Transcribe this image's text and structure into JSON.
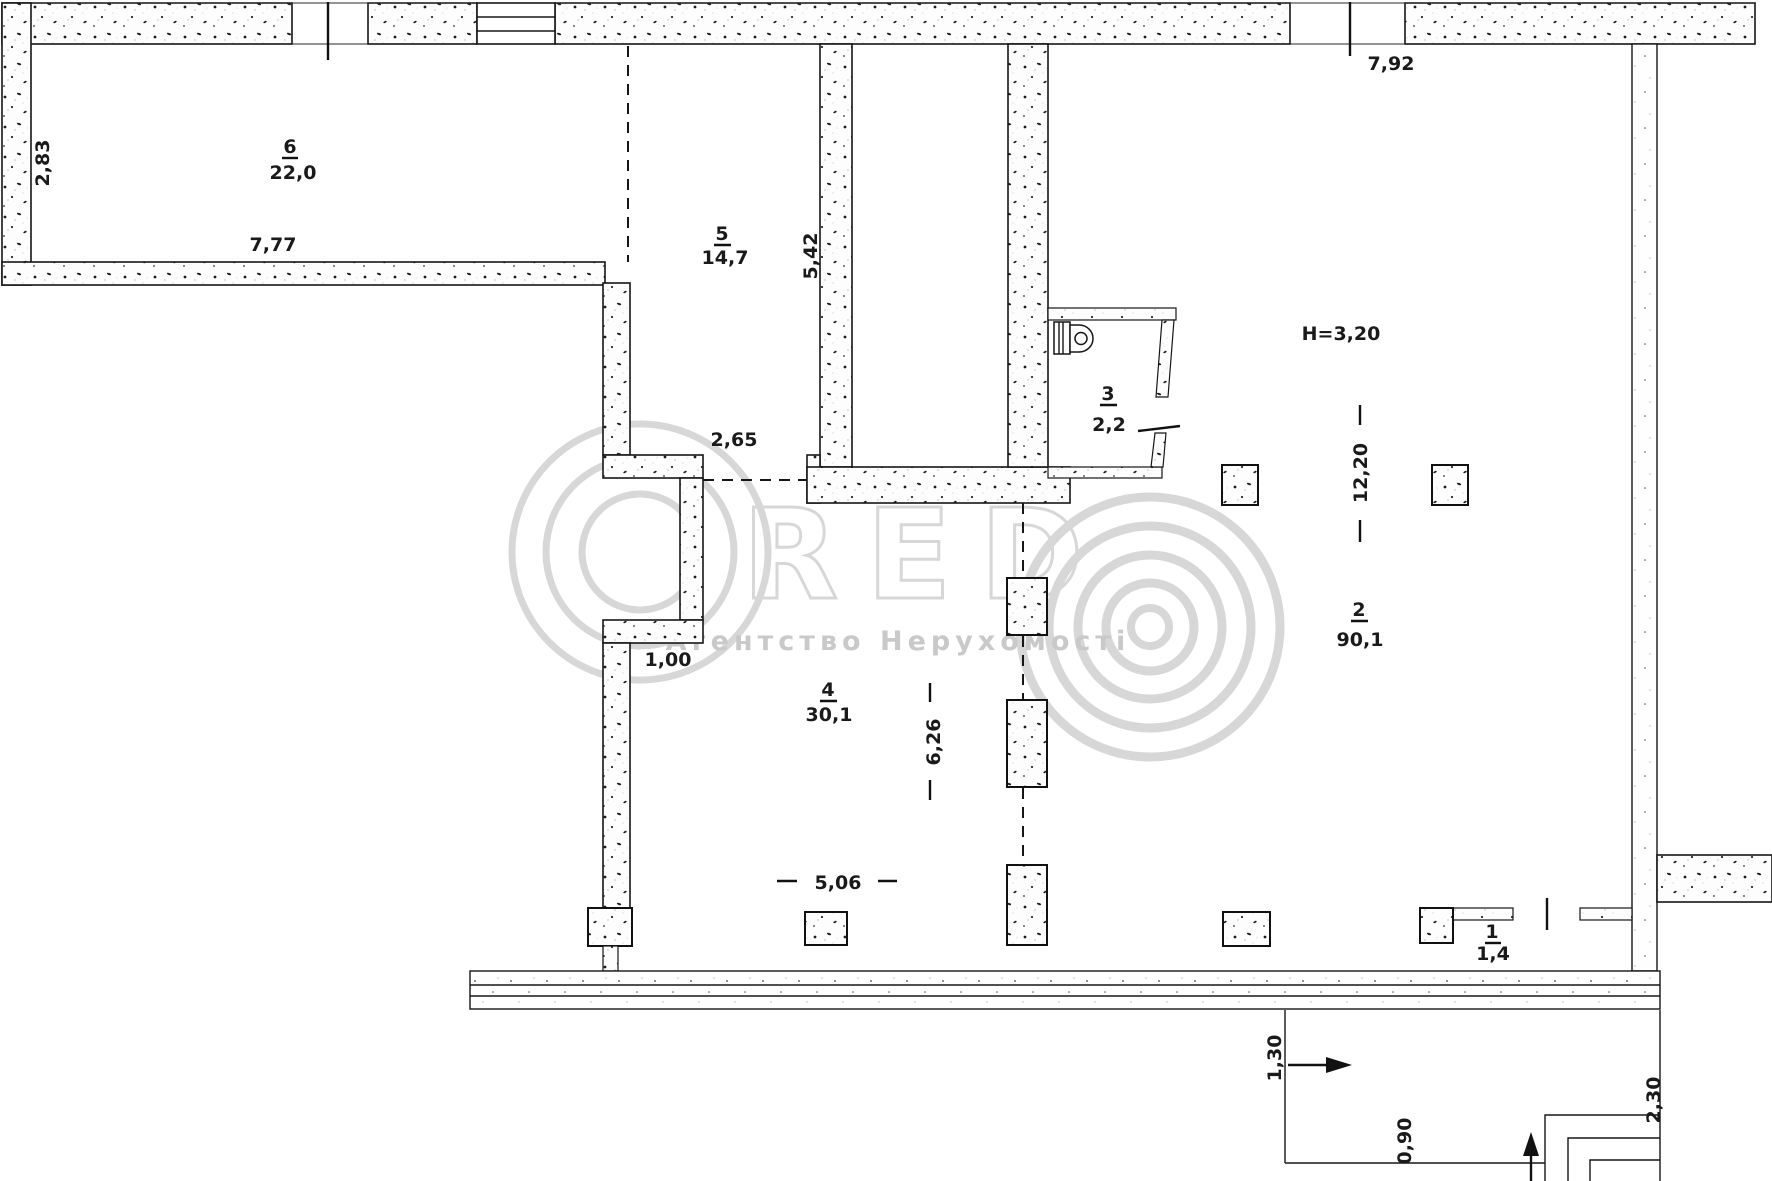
{
  "plan_title": "apartment-floor-plan-scan",
  "rooms": [
    {
      "id": "6",
      "area": "22,0"
    },
    {
      "id": "5",
      "area": "14,7"
    },
    {
      "id": "3",
      "area": "2,2"
    },
    {
      "id": "2",
      "area": "90,1"
    },
    {
      "id": "4",
      "area": "30,1"
    },
    {
      "id": "1",
      "area": "1,4"
    }
  ],
  "dimensions": {
    "left_wall_height": "2,83",
    "room6_width": "7,77",
    "room5_height": "5,42",
    "room4_opening": "2,65",
    "top_entrance_width": "7,92",
    "ceiling_height": "H=3,20",
    "hall_length": "12,20",
    "room4_length": "6,26",
    "wall_jog": "1,00",
    "column_span": "5,06",
    "porch_depth": "1,30",
    "porch_step": "0,90",
    "porch_side": "2,30"
  },
  "watermark": {
    "letter_c": "C",
    "letters_red": "RED",
    "agency": "Агентство Нерухомості"
  },
  "colors": {
    "paper": "#ffffff",
    "ink": "#1a1a1a",
    "watermark_gray": "#d7d7d7",
    "agency_gray": "#c9c9c9"
  }
}
